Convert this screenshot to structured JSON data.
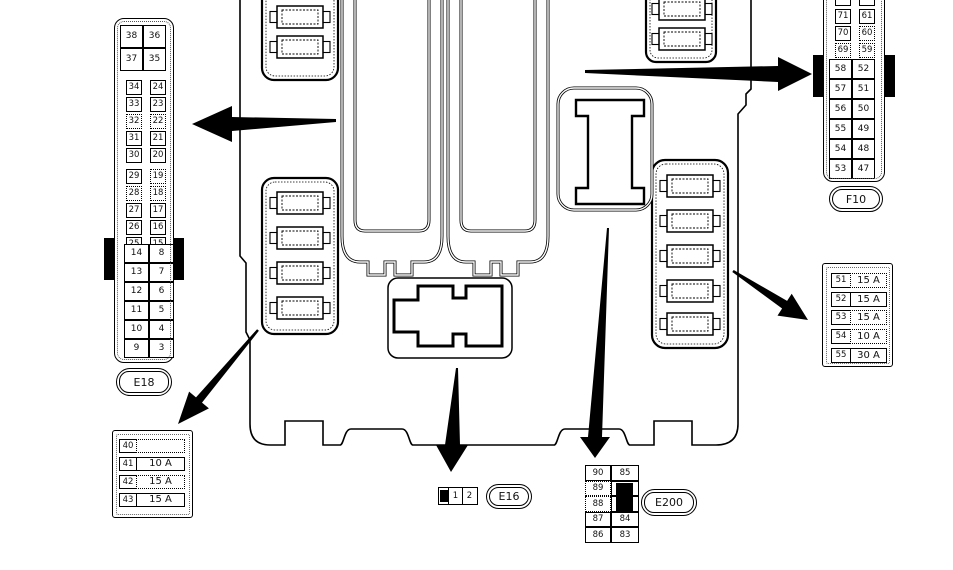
{
  "colors": {
    "line": "#000000",
    "background": "#ffffff"
  },
  "e18": {
    "label": "E18",
    "sec_a": [
      [
        "38",
        "36"
      ],
      [
        "37",
        "35"
      ]
    ],
    "sec_b": [
      [
        "34",
        "24"
      ],
      [
        "33",
        "23"
      ],
      [
        "32",
        "22"
      ],
      [
        "31",
        "21"
      ],
      [
        "30",
        "20"
      ]
    ],
    "sec_c": [
      [
        "29",
        "19"
      ],
      [
        "28",
        "18"
      ],
      [
        "27",
        "17"
      ],
      [
        "26",
        "16"
      ],
      [
        "25",
        "15"
      ]
    ],
    "sec_d": [
      [
        "14",
        "8"
      ],
      [
        "13",
        "7"
      ],
      [
        "12",
        "6"
      ],
      [
        "11",
        "5"
      ],
      [
        "10",
        "4"
      ],
      [
        "9",
        "3"
      ]
    ]
  },
  "f10": {
    "label": "F10",
    "sec_top": [
      [
        "72",
        "62"
      ],
      [
        "71",
        "61"
      ],
      [
        "70",
        "60"
      ],
      [
        "69",
        "59"
      ]
    ],
    "sec_bottom": [
      [
        "58",
        "52"
      ],
      [
        "57",
        "51"
      ],
      [
        "56",
        "50"
      ],
      [
        "55",
        "49"
      ],
      [
        "54",
        "48"
      ],
      [
        "53",
        "47"
      ]
    ]
  },
  "fuse_table_right": {
    "rows": [
      [
        "51",
        "15 A"
      ],
      [
        "52",
        "15 A"
      ],
      [
        "53",
        "15 A"
      ],
      [
        "54",
        "10 A"
      ],
      [
        "55",
        "30 A"
      ]
    ]
  },
  "fuse_table_bottom_left": {
    "rows": [
      [
        "40",
        ""
      ],
      [
        "41",
        "10 A"
      ],
      [
        "42",
        "15 A"
      ],
      [
        "43",
        "15 A"
      ]
    ]
  },
  "e16": {
    "label": "E16",
    "cells": [
      "1",
      "2"
    ]
  },
  "e200": {
    "label": "E200",
    "left_col": [
      "90",
      "89",
      "88",
      "87",
      "86"
    ],
    "right_top": "85",
    "right_bottom": [
      "84",
      "83"
    ]
  }
}
